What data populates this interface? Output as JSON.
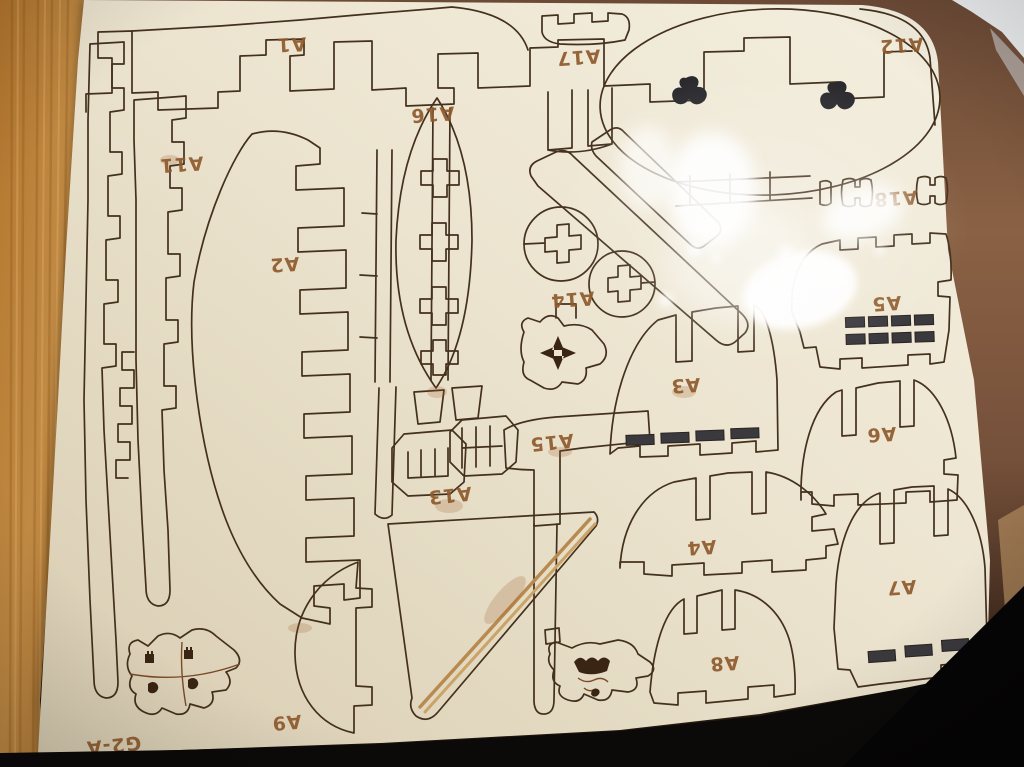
{
  "sheet": {
    "part_labels": {
      "a1": "A1",
      "a2": "A2",
      "a3": "A3",
      "a4": "A4",
      "a5": "A5",
      "a6": "A6",
      "a7": "A7",
      "a8": "A8",
      "a9": "A9",
      "a11": "A11",
      "a12": "A12",
      "a13": "A13",
      "a14": "A14",
      "a15": "A15",
      "a16": "A16",
      "a17": "A17",
      "a18": "A18",
      "sheet_id": "G2-A"
    },
    "engravings": [
      "maltese-cross",
      "quartered-coat-of-arms",
      "crown-crest",
      "yard-stick-lines"
    ],
    "colors": {
      "plywood": "#ece4cf",
      "cut_line": "#43301d",
      "label_burn": "#8e5a2c",
      "slot_cutout": "#3a393e",
      "table_wood_light": "#b97c35",
      "table_wood_dark": "#6a4833",
      "background_shadow": "#0c0a09",
      "glare": "#ffffff"
    }
  }
}
